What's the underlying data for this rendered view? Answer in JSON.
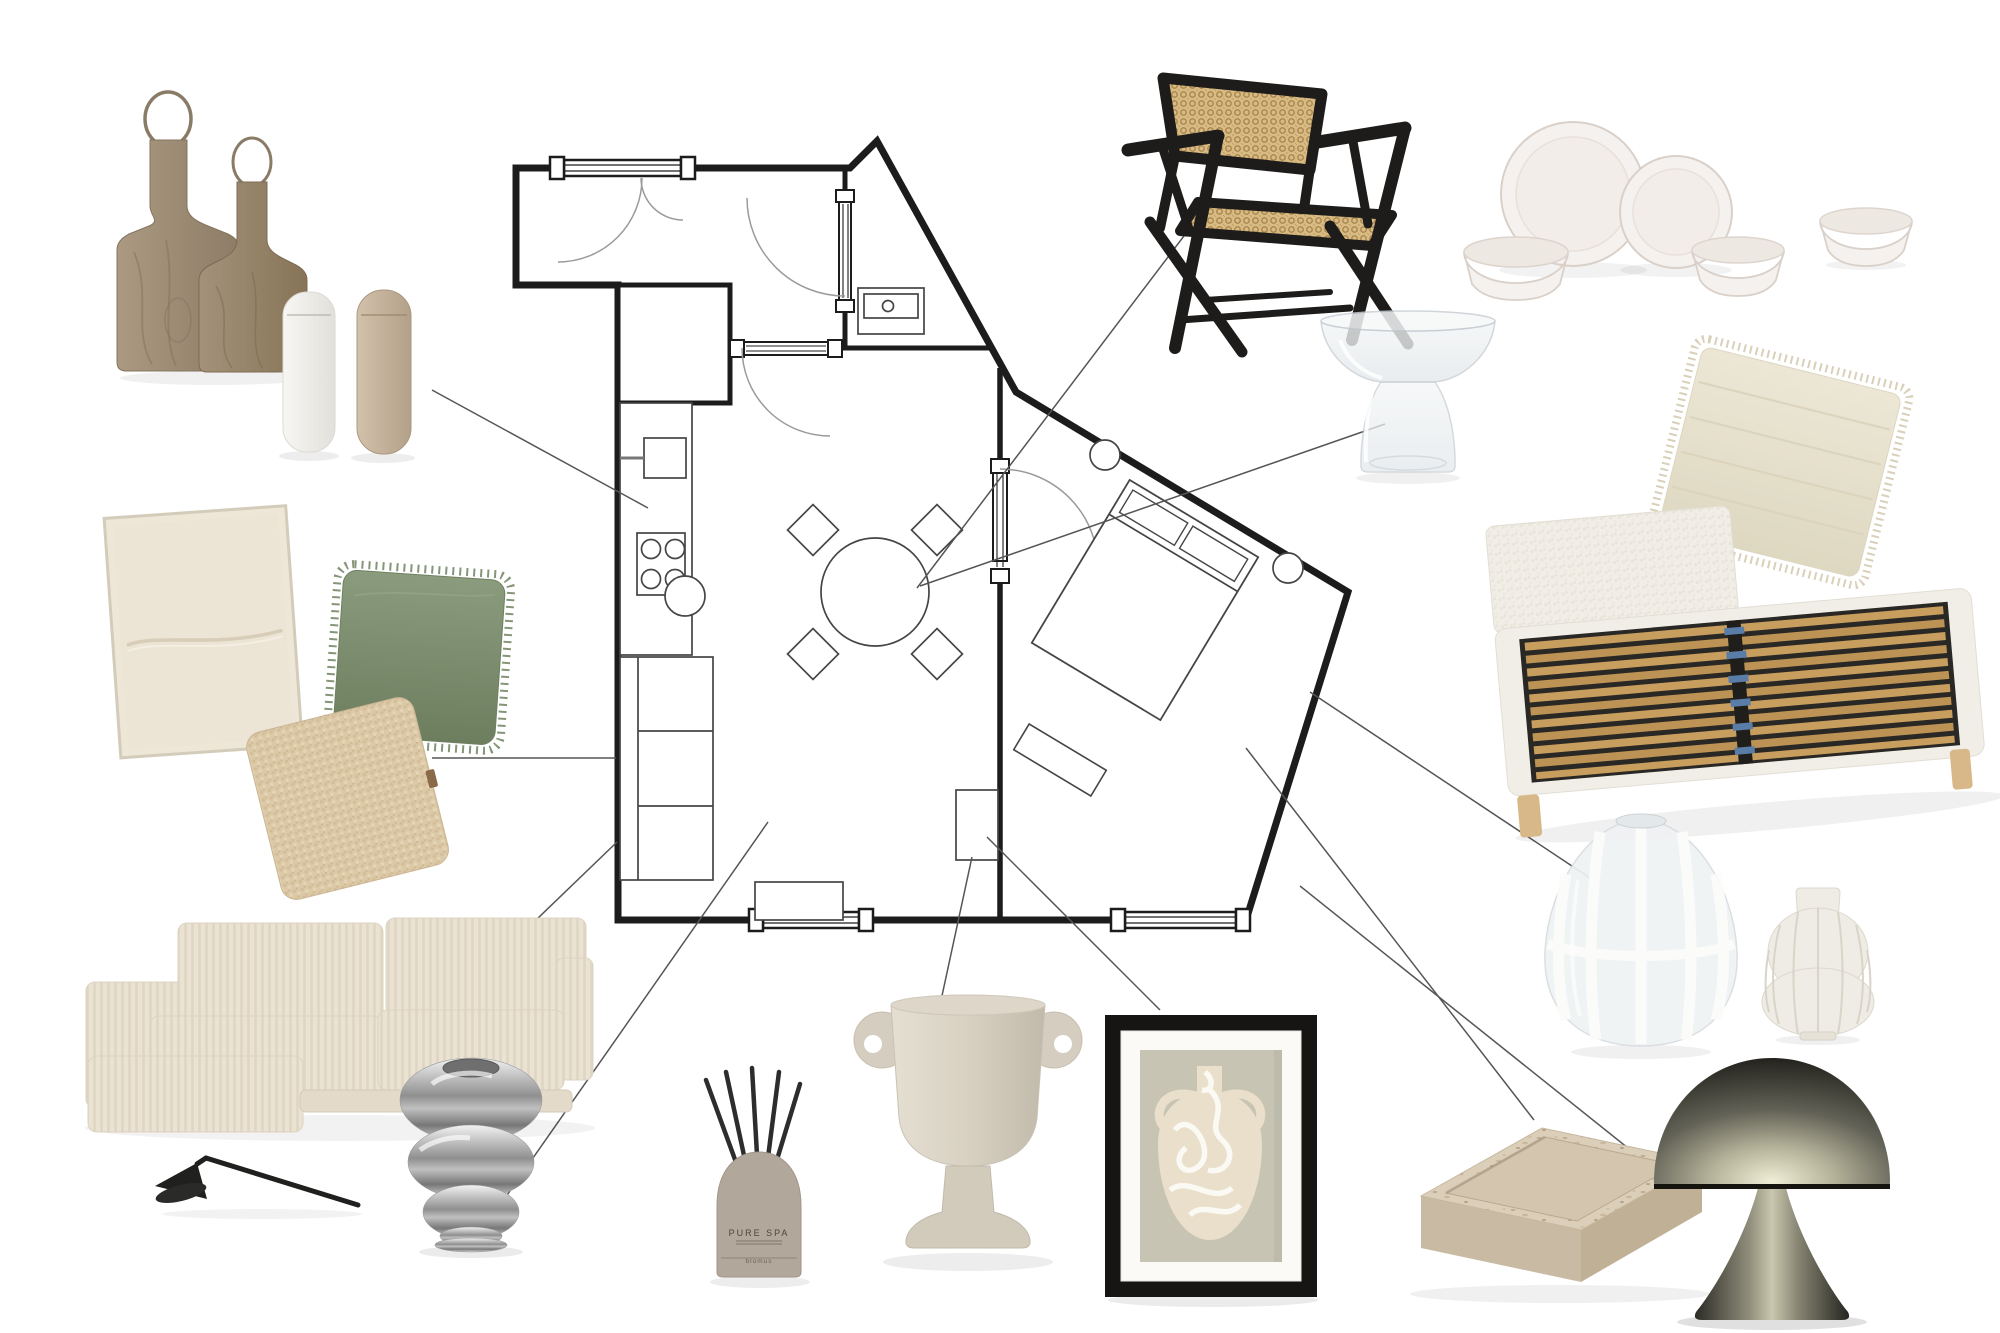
{
  "board": {
    "title": "interior-design-mood-board-with-floor-plan",
    "background": "#ffffff",
    "wall_color": "#1c1c1c",
    "connector_line_color": "#555555",
    "connector_line_count": 11,
    "floor_plan": {
      "rooms": [
        "entry-hall",
        "bathroom",
        "kitchen",
        "living-dining-room",
        "bedroom"
      ],
      "symbols": [
        "entry-double-door-window",
        "door-swing-arcs",
        "pocket-doors",
        "wardrobe-closet",
        "kitchen-counter",
        "kitchen-sink",
        "stove-4-burner",
        "sectional-sofa",
        "stool",
        "round-dining-table-4-chairs",
        "bathroom-vanity",
        "media-console",
        "wall-shelf",
        "double-bed-rotated",
        "pillows",
        "nightstands",
        "dresser",
        "bottom-windows"
      ]
    },
    "items": [
      {
        "id": "cutting-boards",
        "desc": "two wooden cutting boards with wire hanging loops",
        "colors": [
          "#ab9a81",
          "#8d7c66"
        ]
      },
      {
        "id": "salt-pepper-grinders",
        "desc": "white and beige electric grinders",
        "colors": [
          "#f6f5f2",
          "#c9b7a0"
        ]
      },
      {
        "id": "cane-armchair",
        "desc": "black wood armchair with rattan cane back and seat",
        "colors": [
          "#1e1c1b",
          "#d8bb82"
        ]
      },
      {
        "id": "dinnerware-set",
        "desc": "white stoneware: 2 plates and 3 bowls",
        "colors": [
          "#f5f1ee"
        ]
      },
      {
        "id": "glass-side-table",
        "desc": "clear hammered glass hourglass side table",
        "colors": [
          "#eef1f3"
        ]
      },
      {
        "id": "cream-fringed-pillow",
        "desc": "cream woven fringed square cushion",
        "colors": [
          "#ece7d5"
        ]
      },
      {
        "id": "upholstered-bed",
        "desc": "white boucle bed frame with wooden slat base and blue clips",
        "colors": [
          "#f1eee7",
          "#c89e5f",
          "#5a7da8"
        ]
      },
      {
        "id": "canvas-artwork",
        "desc": "beige textured linen canvas in thin frame",
        "colors": [
          "#ece4d4"
        ]
      },
      {
        "id": "green-fringed-cushion",
        "desc": "sage green linen cushion with fringe",
        "colors": [
          "#7d9071"
        ]
      },
      {
        "id": "boucle-cushion",
        "desc": "beige boucle square cushion with leather tag",
        "colors": [
          "#dcc9a7"
        ]
      },
      {
        "id": "corduroy-sofa",
        "desc": "cream corduroy sectional sofa with chaise",
        "colors": [
          "#eae2d3"
        ]
      },
      {
        "id": "candle-snuffer",
        "desc": "black metal candle snuffer",
        "colors": [
          "#20201e"
        ]
      },
      {
        "id": "chrome-bubble-vase",
        "desc": "silver chrome stacked-bubble vase",
        "colors": [
          "#c6c6c6"
        ]
      },
      {
        "id": "reed-diffuser",
        "desc": "taupe reed diffuser with black sticks",
        "colors": [
          "#b2a79b"
        ]
      },
      {
        "id": "urn-vase",
        "desc": "beige urn vase with round ear handles",
        "colors": [
          "#d8d1c2"
        ]
      },
      {
        "id": "framed-vase-print",
        "desc": "black framed art print of cream amphora with white scribbles on sage ground",
        "colors": [
          "#161514",
          "#c7c4b4",
          "#e9dfca"
        ]
      },
      {
        "id": "striped-glass-vase",
        "desc": "egg-shaped glass vase with white stripes",
        "colors": [
          "#eff2f3",
          "#ffffff"
        ]
      },
      {
        "id": "pleated-vase",
        "desc": "white pleated double-gourd vase",
        "colors": [
          "#efece5"
        ]
      },
      {
        "id": "travertine-tray",
        "desc": "rectangular travertine stone tray",
        "colors": [
          "#dbcfba"
        ]
      },
      {
        "id": "mushroom-table-lamp",
        "desc": "gunmetal mushroom dome table lamp",
        "colors": [
          "#66655a"
        ]
      }
    ]
  },
  "diffuser": {
    "label": "PURE SPA",
    "brand": "blomus"
  }
}
